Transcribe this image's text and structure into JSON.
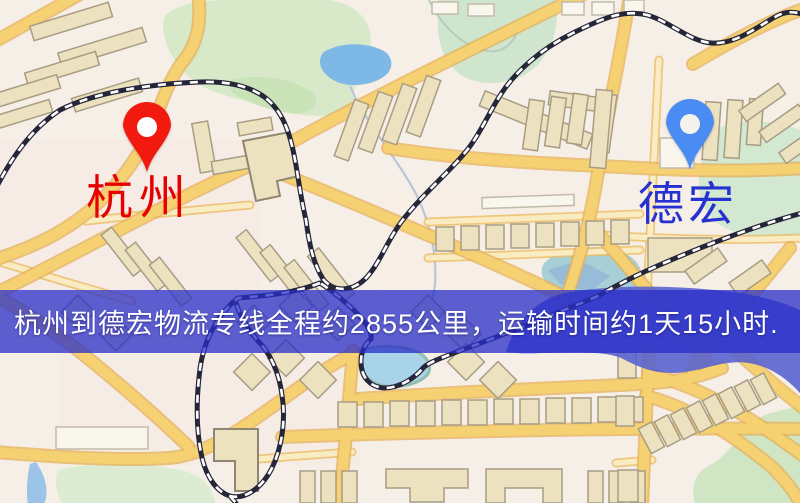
{
  "map": {
    "origin": {
      "label": "杭州",
      "pin_color": "#f2190f",
      "label_color": "#e60000"
    },
    "destination": {
      "label": "德宏",
      "pin_color": "#4b8cf4",
      "label_color": "#2531d0"
    },
    "icons": {
      "origin_pin": "map-pin-icon",
      "destination_pin": "map-pin-icon"
    },
    "colors": {
      "background": "#f6efe7",
      "road_main": "#f5d172",
      "road_casing": "#e6b057",
      "park_green": "#d8e9c9",
      "lake_blue": "#7db8e6",
      "deep_water": "#5560cf",
      "railway_dark": "#26263a"
    }
  },
  "banner": {
    "text": "杭州到德宏物流专线全程约2855公里，运输时间约1天15小时.",
    "background": "rgba(40,45,200,0.75)",
    "text_color": "#ffffff"
  }
}
